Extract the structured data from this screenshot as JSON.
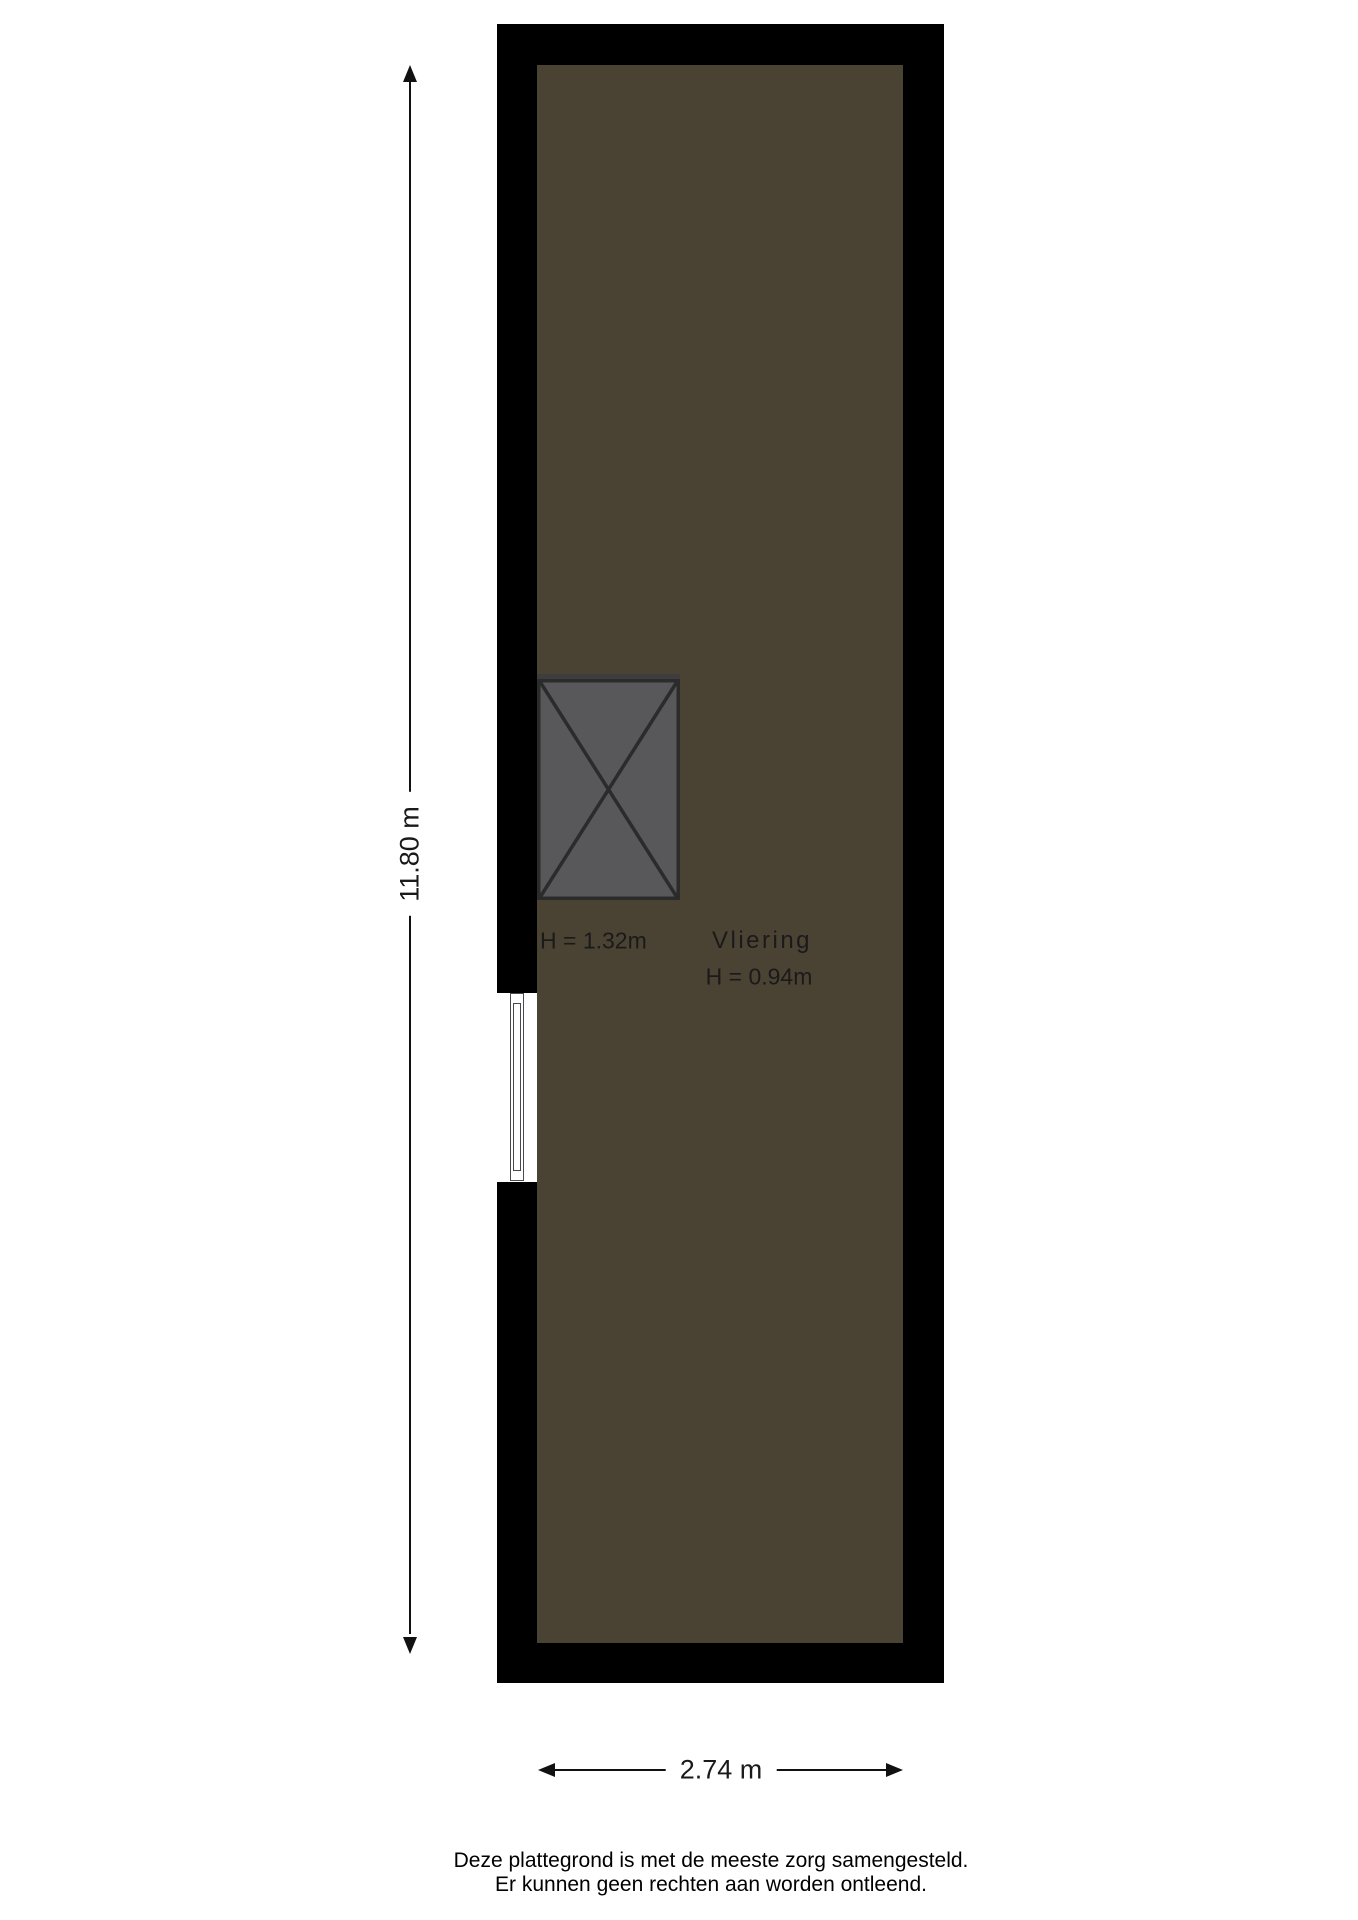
{
  "floorplan": {
    "room": {
      "name": "Vliering",
      "height_label": "H = 0.94m"
    },
    "hatch": {
      "height_label": "H = 1.32m"
    },
    "dimensions": {
      "vertical_label": "11.80 m",
      "horizontal_label": "2.74 m"
    },
    "colors": {
      "wall": "#000000",
      "floor": "#4a4333",
      "hatch_fill": "#58585a",
      "hatch_stroke": "#2b2b2b",
      "hatch_top_band": "#3d3d3d",
      "window_frame": "#4a4a4a",
      "dimension_line": "#111111",
      "text": "#1a1a1a"
    }
  },
  "footer": {
    "line1": "Deze plattegrond is met de meeste zorg samengesteld.",
    "line2": "Er kunnen geen rechten aan worden ontleend."
  }
}
